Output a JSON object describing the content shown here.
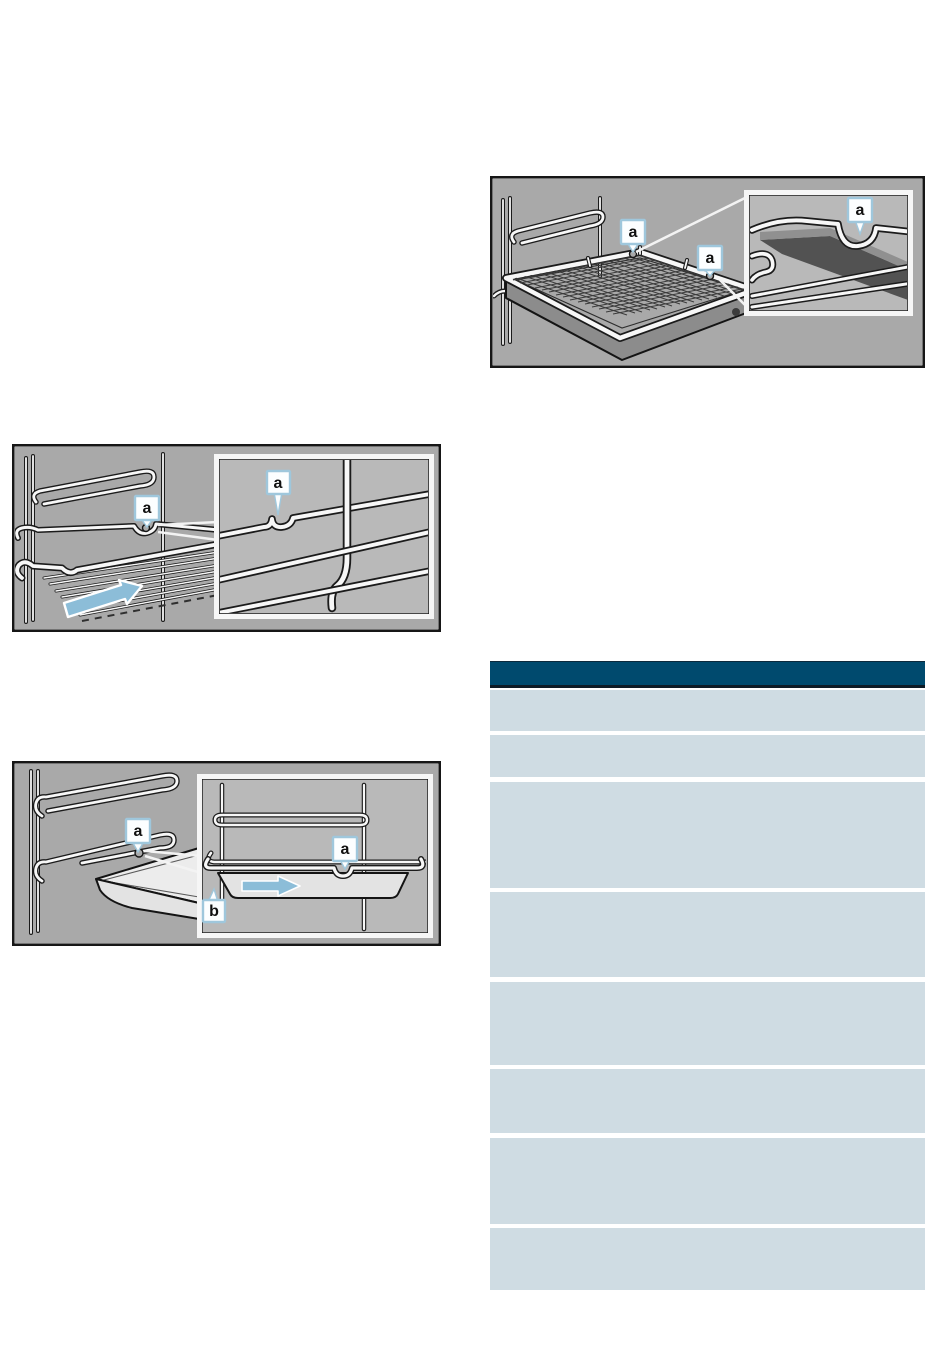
{
  "page": {
    "width": 950,
    "height": 1370,
    "bg": "#ffffff"
  },
  "colors": {
    "page_bg": "#ffffff",
    "figure_bg": "#a9a9a9",
    "figure_inset_bg": "#b9b9b9",
    "figure_border": "#161616",
    "inset_frame": "#f6f6f6",
    "marker_box_bg": "#fcfeff",
    "marker_box_border": "#9fc7dc",
    "marker_text": "#101010",
    "arrow_fill": "#8cbdd8",
    "table_header_bg": "#004a6e",
    "table_header_top_edge": "#0c2a3d",
    "table_header_bottom_edge": "#0e1b26",
    "table_row_bg": "#cfdce3"
  },
  "figures": {
    "fig1": {
      "markers": {
        "a": "a"
      }
    },
    "fig2": {
      "markers": {
        "a": "a"
      }
    },
    "fig3": {
      "markers": {
        "a": "a",
        "b": "b"
      }
    }
  },
  "table": {
    "header_text": "",
    "rows": [
      {
        "top": 29,
        "height": 41
      },
      {
        "top": 74,
        "height": 42
      },
      {
        "top": 121,
        "height": 106
      },
      {
        "top": 231,
        "height": 85
      },
      {
        "top": 321,
        "height": 83
      },
      {
        "top": 408,
        "height": 64
      },
      {
        "top": 477,
        "height": 86
      },
      {
        "top": 567,
        "height": 62
      }
    ]
  }
}
